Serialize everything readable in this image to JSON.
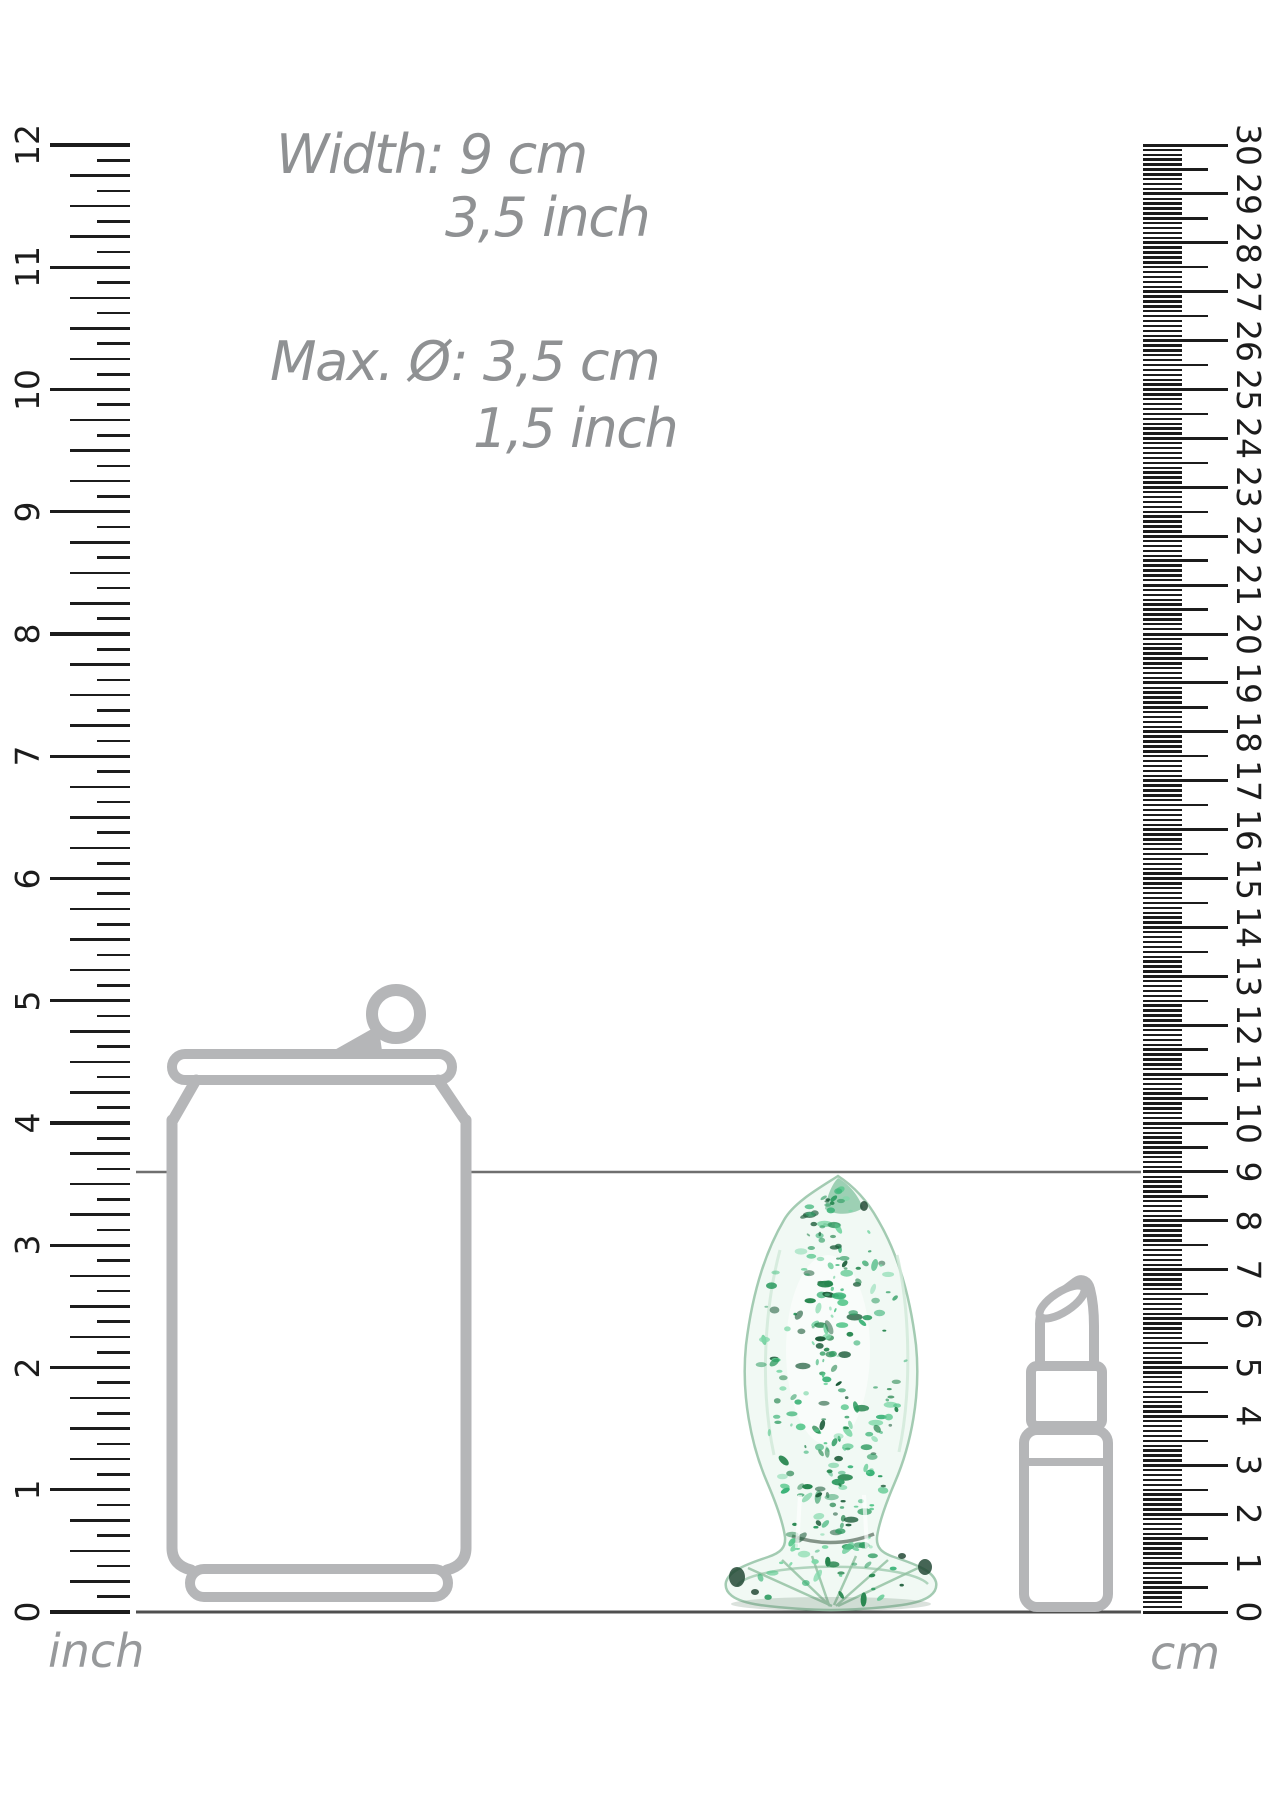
{
  "annotations": {
    "width_line1": "Width: 9 cm",
    "width_line2": "3,5 inch",
    "diameter_line1": "Max. Ø: 3,5 cm",
    "diameter_line2": "1,5 inch"
  },
  "inch_ruler": {
    "unit_label": "inch",
    "numbers": [
      0,
      1,
      2,
      3,
      4,
      5,
      6,
      7,
      8,
      9,
      10,
      11,
      12
    ]
  },
  "cm_ruler": {
    "unit_label": "cm",
    "numbers": [
      0,
      1,
      2,
      3,
      4,
      5,
      6,
      7,
      8,
      9,
      10,
      11,
      12,
      13,
      14,
      15,
      16,
      17,
      18,
      19,
      20,
      21,
      22,
      23,
      24,
      25,
      26,
      27,
      28,
      29,
      30
    ]
  },
  "colors": {
    "tick": "#1c1c1c",
    "annotation_text": "#8f9193",
    "unit_label_text": "#97999b",
    "outline_gray": "#b5b6b8",
    "reference_line": "#6f6f6f",
    "baseline": "#4f4f4f",
    "glass_outline": "#a3cbb2",
    "glass_fill": "#f1f9f4",
    "speckle_palette": [
      "#3bb377",
      "#2f9c62",
      "#57c78c",
      "#27864f",
      "#7ed8a8",
      "#1d5c3a"
    ]
  },
  "objects": {
    "product": "glass plug with green glow speckles",
    "reference_object_1": "soda can outline",
    "reference_object_2": "lipstick outline"
  }
}
